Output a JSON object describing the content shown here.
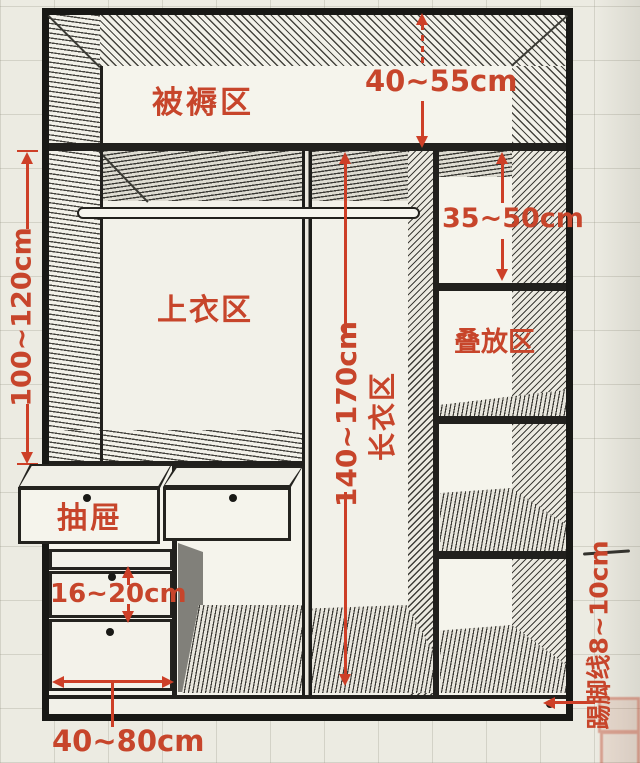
{
  "diagram": {
    "labels": {
      "bedding_zone": "被褥区",
      "tops_zone": "上衣区",
      "stacking_zone": "叠放区",
      "long_clothes_zone": "长衣区",
      "drawer": "抽屉"
    },
    "dims": {
      "bedding_height": "40~55cm",
      "hanging_height": "100~120cm",
      "shelf_height": "35~50cm",
      "long_clothes_height": "140~170cm",
      "drawer_height": "16~20cm",
      "drawer_width": "40~80cm",
      "kickline": "踢脚线8~10cm"
    },
    "colors": {
      "annotation": "#c7452b",
      "outline": "#1d1d1d",
      "paper": "#ecebe2"
    }
  }
}
